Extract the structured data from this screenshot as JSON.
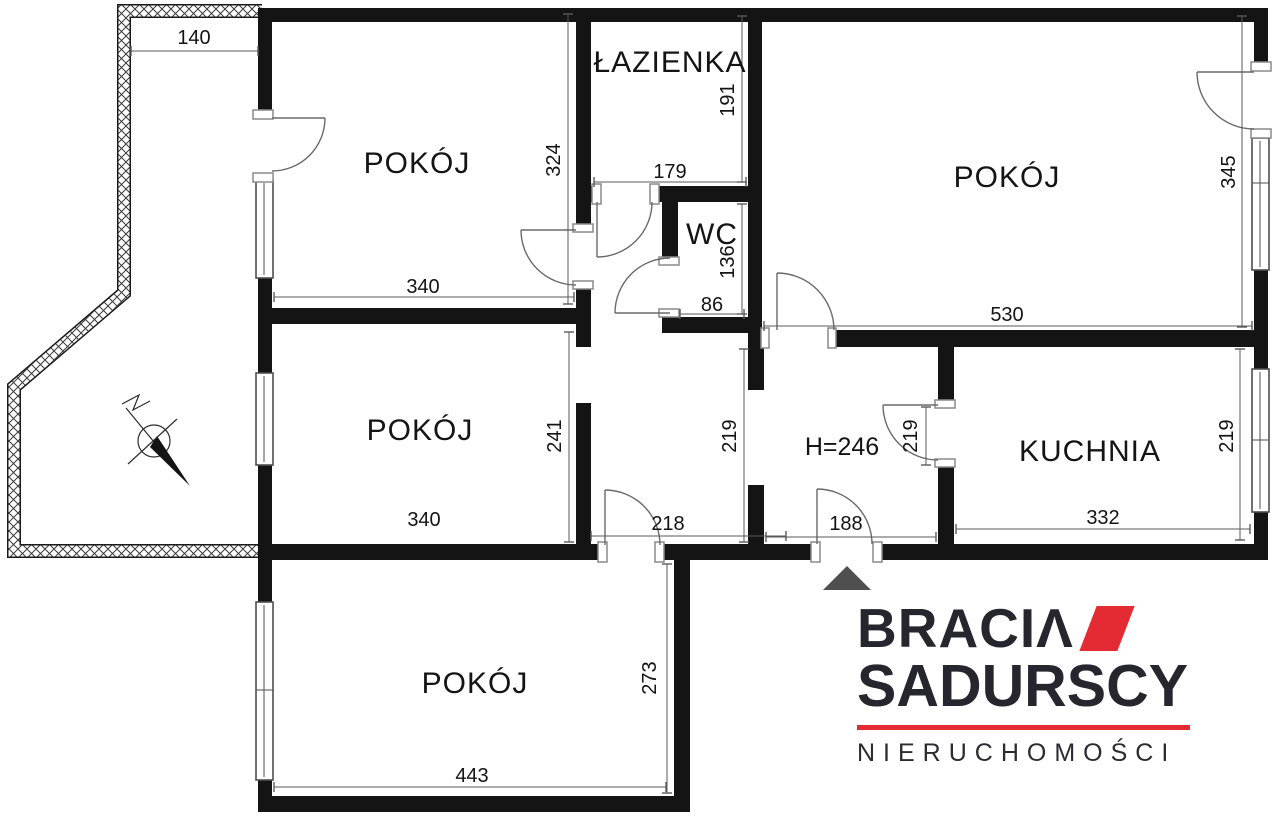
{
  "plan": {
    "rooms": {
      "top_left": "POKÓJ",
      "bathroom": "ŁAZIENKA",
      "wc": "WC",
      "top_right": "POKÓJ",
      "middle_left": "POKÓJ",
      "kitchen": "KUCHNIA",
      "bottom": "POKÓJ",
      "hall_height": "H=246"
    },
    "dims": {
      "balcony_width": "140",
      "room_tl_height": "324",
      "bath_height": "191",
      "bath_width": "179",
      "wc_height": "136",
      "wc_width": "86",
      "room_tl_width": "340",
      "room_tr_width": "530",
      "room_tr_height": "345",
      "room_ml_width": "340",
      "room_ml_height": "241",
      "hall_width": "219",
      "kitchen_door": "219",
      "kitchen_window": "219",
      "kitchen_width": "332",
      "bottom_door": "218",
      "entry_door": "188",
      "room_b_width": "443",
      "room_b_height": "273"
    }
  },
  "logo": {
    "line1": "BRACIΛ",
    "line2": "SADURSCY",
    "line3": "NIERUCHOMOŚCI"
  },
  "colors": {
    "wall": "#141414",
    "dimension_line": "#5a5a5a",
    "logo_red": "#e42a33",
    "logo_dark": "#26262f",
    "entrance_arrow": "#4f4f4f"
  }
}
